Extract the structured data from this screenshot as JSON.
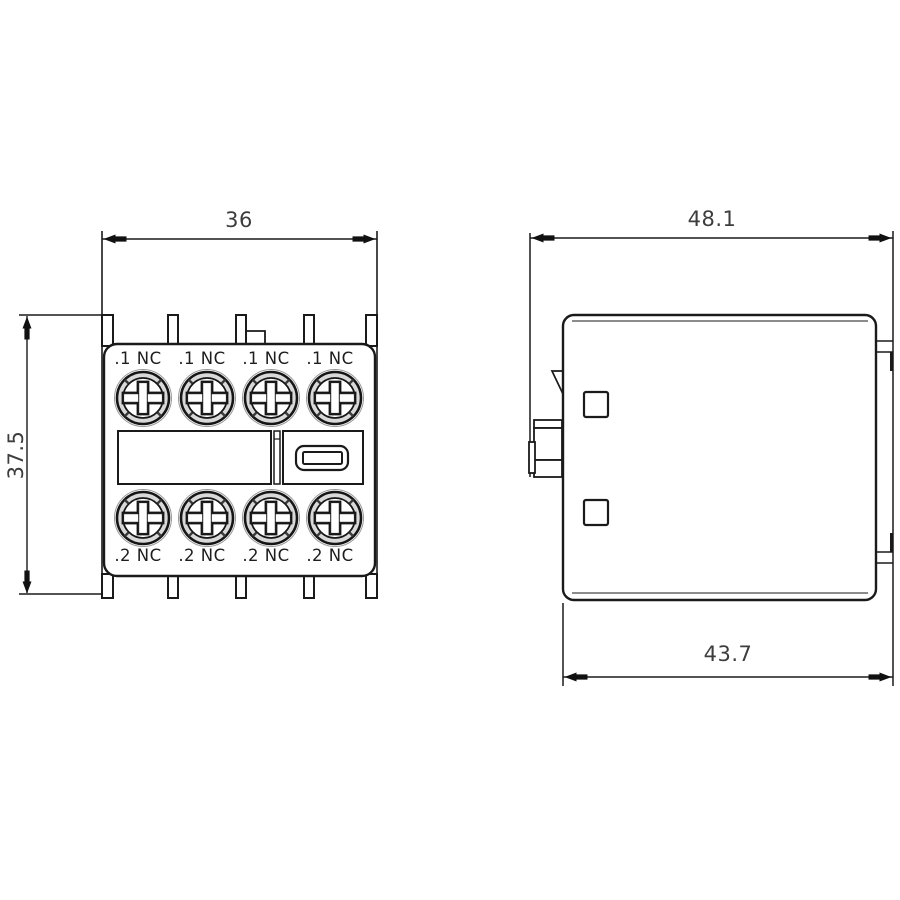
{
  "drawing": {
    "kind": "technical dimensional drawing",
    "subject": "auxiliary contact block (front and side views)",
    "background_color": "#ffffff",
    "line_color": "#1a1a1a"
  },
  "front_view": {
    "name": "front view",
    "width_dimension": "36",
    "height_dimension": "37.5",
    "terminals_top": [
      ".1 NC",
      ".1 NC",
      ".1 NC",
      ".1 NC"
    ],
    "terminals_bottom": [
      ".2 NC",
      ".2 NC",
      ".2 NC",
      ".2 NC"
    ]
  },
  "side_view": {
    "name": "side view",
    "depth_overall_dimension": "48.1",
    "depth_body_dimension": "43.7"
  }
}
